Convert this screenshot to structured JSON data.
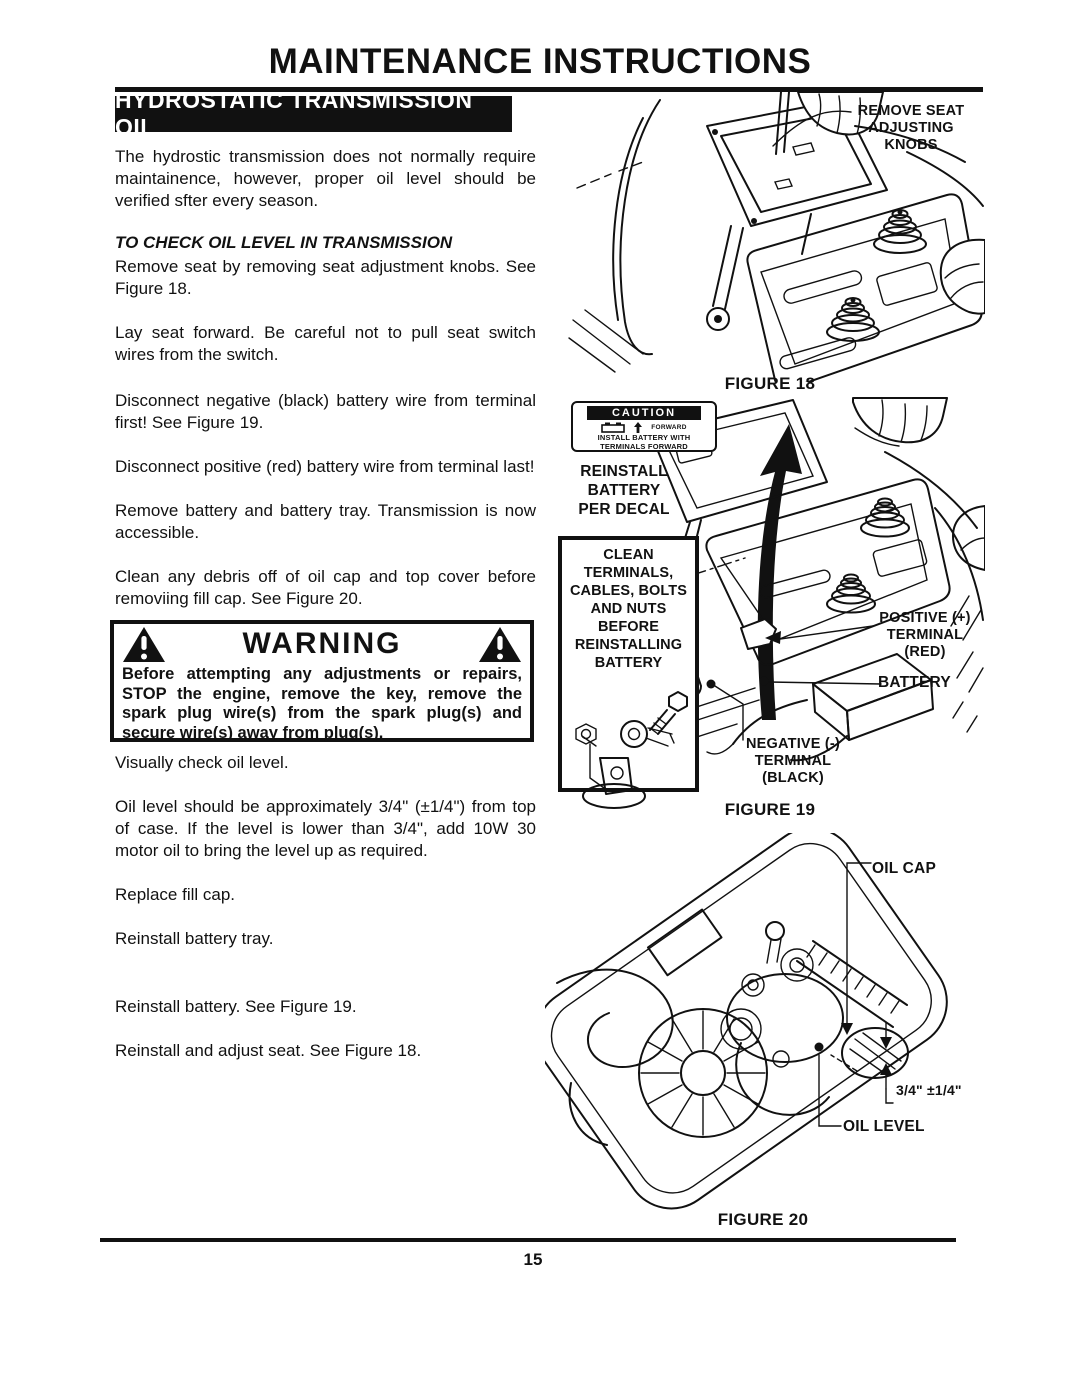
{
  "page": {
    "title": "MAINTENANCE INSTRUCTIONS",
    "number": "15"
  },
  "colors": {
    "ink": "#111111",
    "paper": "#ffffff"
  },
  "left": {
    "section_heading": "HYDROSTATIC TRANSMISSION OIL",
    "intro": "The hydrostic transmission does not normally require maintainence, however, proper oil level should be verified sfter every season.",
    "subheading": "TO CHECK OIL LEVEL IN TRANSMISSION",
    "paragraphs": [
      "Remove seat by removing seat adjustment knobs. See Figure 18.",
      "Lay seat forward. Be careful not to pull seat switch wires from the switch.",
      "Disconnect negative (black) battery wire from terminal first! See Figure 19.",
      "Disconnect positive (red) battery wire from terminal last!",
      "Remove battery and battery tray. Transmission is now accessible.",
      "Clean any debris off of oil cap and top cover before removiing fill cap. See Figure 20.",
      "Visually check oil level.",
      "Oil level should be approximately 3/4\" (±1/4\") from top of case. If the level is lower than 3/4\", add 10W 30 motor oil to bring the level up as required.",
      "Replace fill cap.",
      "Reinstall battery tray.",
      "Reinstall battery. See Figure 19.",
      "Reinstall and adjust seat. See Figure 18."
    ]
  },
  "warning": {
    "title": "WARNING",
    "body": "Before attempting any adjustments or repairs, STOP the engine, remove the key, remove the spark plug wire(s) from the spark plug(s) and secure wire(s) away from plug(s)."
  },
  "fig18": {
    "callout": "REMOVE SEAT\nADJUSTING\nKNOBS",
    "caption": "FIGURE 18"
  },
  "fig19": {
    "decal_title": "CAUTION",
    "decal_forward": "FORWARD",
    "decal_line1": "INSTALL BATTERY WITH",
    "decal_line2": "TERMINALS FORWARD",
    "reinstall_note": "REINSTALL\nBATTERY\nPER DECAL",
    "clean_note": "CLEAN TERMINALS,\nCABLES, BOLTS\nAND NUTS BEFORE\nREINSTALLING\nBATTERY",
    "positive_label": "POSITIVE (+)\nTERMINAL\n(RED)",
    "battery_label": "BATTERY",
    "negative_label": "NEGATIVE (-)\nTERMINAL\n(BLACK)",
    "caption": "FIGURE 19"
  },
  "fig20": {
    "oil_cap_label": "OIL CAP",
    "dimension_label": "3/4\" ±1/4\"",
    "oil_level_label": "OIL LEVEL",
    "caption": "FIGURE 20"
  }
}
